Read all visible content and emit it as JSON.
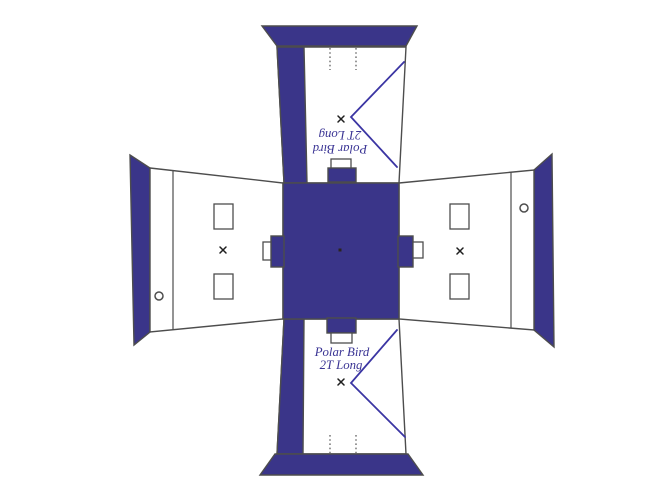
{
  "labels": {
    "brand_line1": "Polar Bird",
    "brand_line2": "2T Long"
  },
  "colors": {
    "panel_fill": "#3a3589",
    "accent_line": "#3b35a3",
    "outline": "#4d4d4d",
    "label_text": "#3a3494",
    "background": "#ffffff"
  }
}
